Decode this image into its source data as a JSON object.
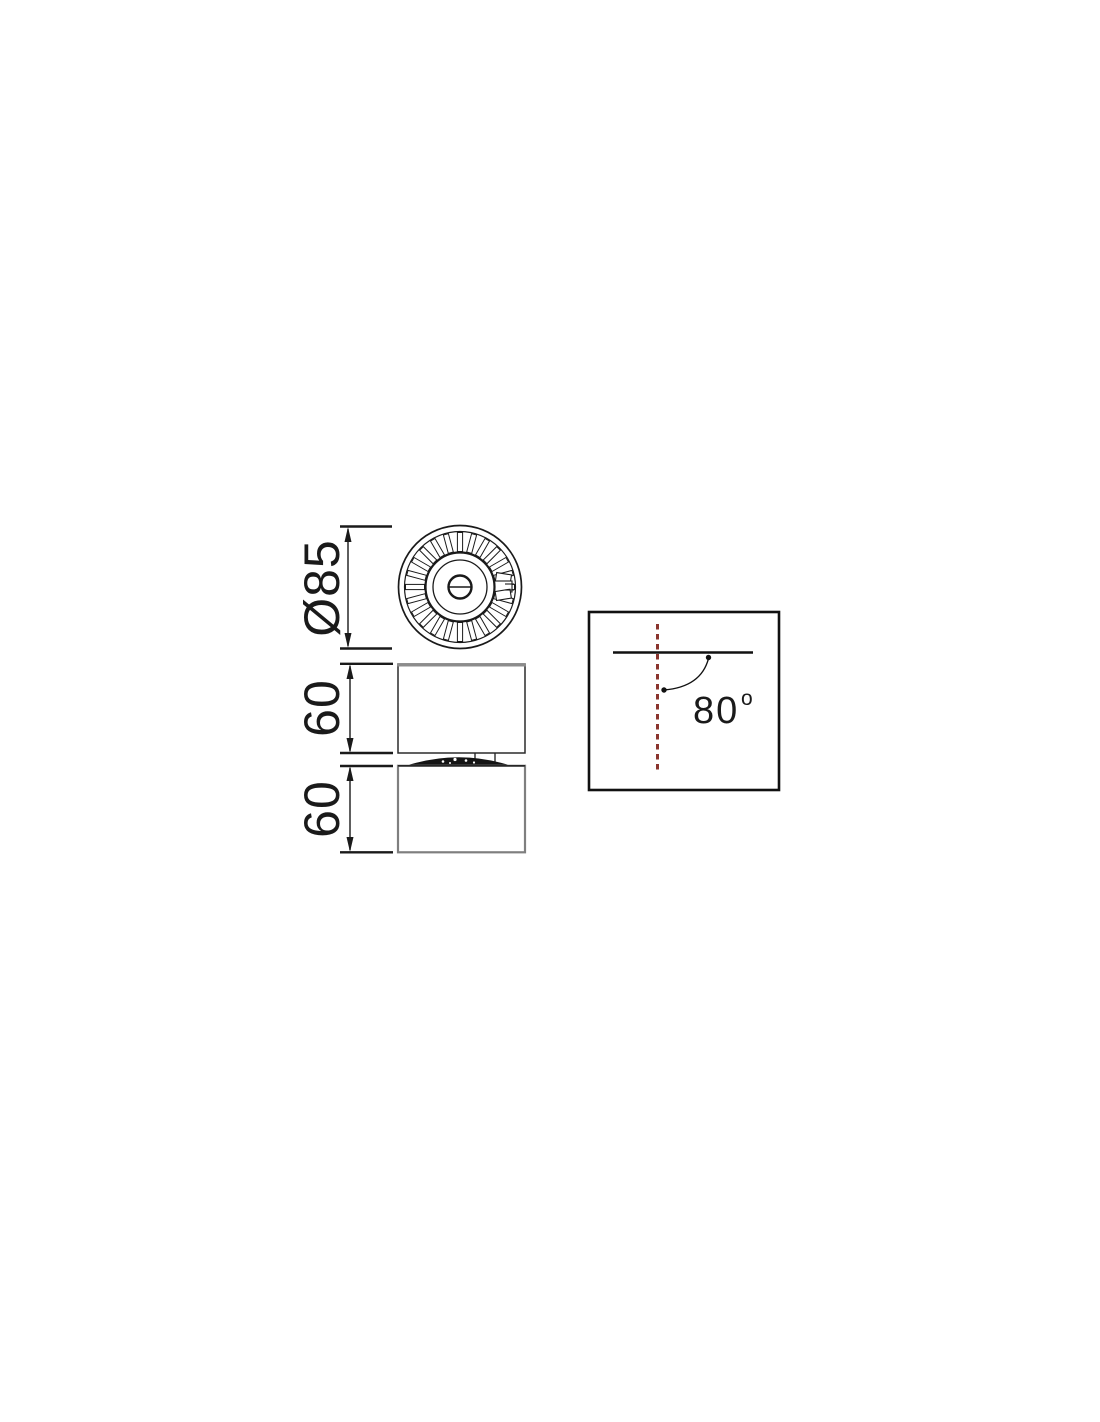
{
  "drawing": {
    "dimensions": {
      "diameter": "Ø85",
      "upper_height": "60",
      "lower_height": "60"
    },
    "tilt": {
      "angle_value": "80",
      "angle_unit": "o"
    }
  },
  "colors": {
    "line": "#1a1a1a",
    "accent_red": "#8a352e",
    "secondary_gray": "#7f7f7f"
  }
}
